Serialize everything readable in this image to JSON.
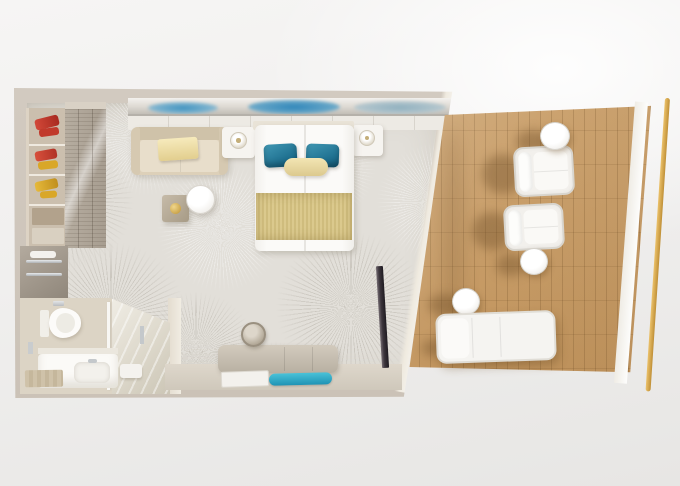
{
  "scene": {
    "description": "Top-down 3D rendered floor plan of a cruise balcony stateroom with bedroom, bathroom, wardrobe and private wooden-deck balcony",
    "view": "top-down",
    "areas": [
      "bedroom",
      "bathroom",
      "wardrobe",
      "balcony"
    ]
  },
  "palette": {
    "background": "#efeeec",
    "wall": "#cfc7bd",
    "carpet": "#e2dfd9",
    "deck_wood": "#c89e66",
    "railing_gold": "#d0a449",
    "accent_teal": "#27809f",
    "bed_runner_gold": "#d4c183",
    "throw_cream": "#eddfa9",
    "sofa_beige": "#ddd0b9",
    "furniture_white": "#f6f5f2",
    "tv_dark": "#2b262c",
    "shoe_red": "#c93c2e",
    "shoe_yellow": "#d9a728",
    "art_blue": "#3b8fc0"
  },
  "bedroom": {
    "furniture": [
      {
        "name": "double-bed",
        "detail": "two joined twin beds, white duvets, 2 teal pillows, cream bolster, gold foot runner"
      },
      {
        "name": "nightstand",
        "count": 2,
        "detail": "white, one round lamp each"
      },
      {
        "name": "sofa",
        "detail": "beige two-seater with cream throw blanket"
      },
      {
        "name": "round-side-table",
        "detail": "white"
      },
      {
        "name": "square-side-table",
        "detail": "taupe with gold ornament"
      },
      {
        "name": "desk-dresser",
        "detail": "taupe with round mirror, white book and teal tray"
      },
      {
        "name": "wall-art",
        "detail": "blue abstract strip above headboard wall"
      },
      {
        "name": "tv",
        "detail": "dark flat panel mounted on right wall"
      }
    ]
  },
  "wardrobe": {
    "furniture": [
      {
        "name": "open-shelf-unit",
        "detail": "red and yellow shoes, beige storage boxes"
      },
      {
        "name": "sliding-door-closet",
        "detail": "taupe louvered doors"
      },
      {
        "name": "luggage-bench",
        "detail": "taupe with chrome rails and towel roll"
      }
    ]
  },
  "bathroom": {
    "fixtures": [
      {
        "name": "toilet",
        "detail": "white"
      },
      {
        "name": "vanity-sink",
        "detail": "white counter, chrome faucet"
      },
      {
        "name": "shower",
        "detail": "glass enclosure with chrome fittings"
      },
      {
        "name": "bath-mat",
        "detail": "beige striped"
      }
    ]
  },
  "balcony": {
    "furniture": [
      {
        "name": "armchair",
        "count": 2,
        "detail": "white, facing the railing"
      },
      {
        "name": "round-side-table",
        "count": 3,
        "detail": "white"
      },
      {
        "name": "sun-lounger",
        "detail": "white cushioned"
      },
      {
        "name": "railing",
        "detail": "gold handrail along outer edge"
      },
      {
        "name": "deck",
        "detail": "teak wood plank flooring"
      }
    ]
  }
}
